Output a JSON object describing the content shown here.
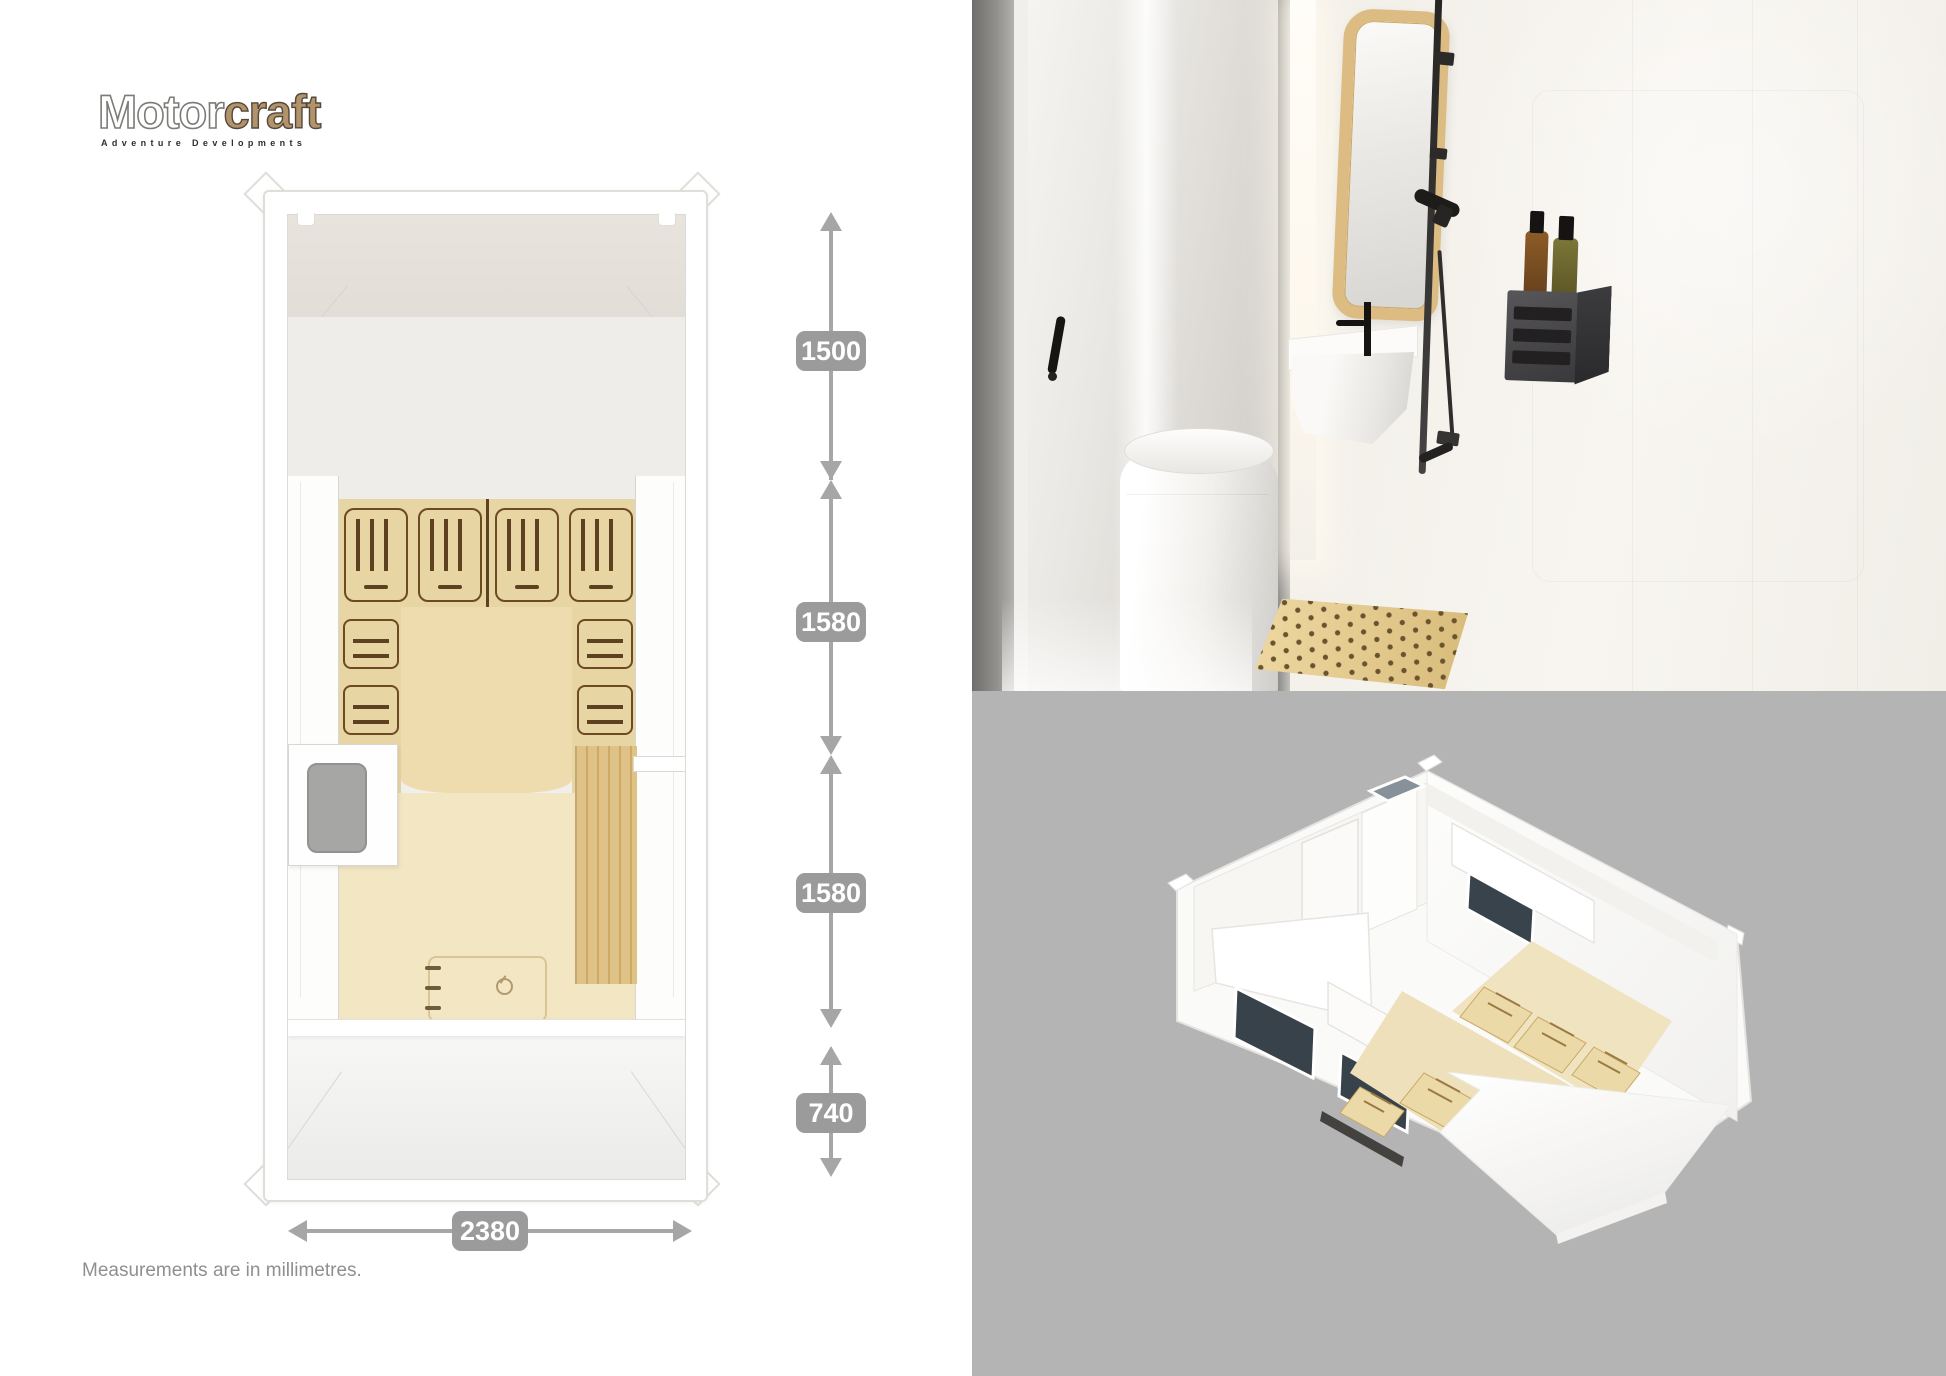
{
  "logo": {
    "word_main": "Motor",
    "word_accent": "craft",
    "tagline": "Adventure Developments",
    "accent_color": "#b2936b"
  },
  "dims": {
    "unit_note": "Measurements are in millimetres.",
    "v": [
      {
        "label": "1500"
      },
      {
        "label": "1580"
      },
      {
        "label": "1580"
      },
      {
        "label": "740"
      }
    ],
    "h": {
      "label": "2380"
    }
  },
  "colors": {
    "badge": "#9b9b9b",
    "dimension_line": "#a6a6a6",
    "iso_background": "#b4b4b5",
    "wood_cabinet": "#e8d5a4",
    "wood_floor": "#f2e6c3",
    "logo_accent": "#b2936b"
  }
}
